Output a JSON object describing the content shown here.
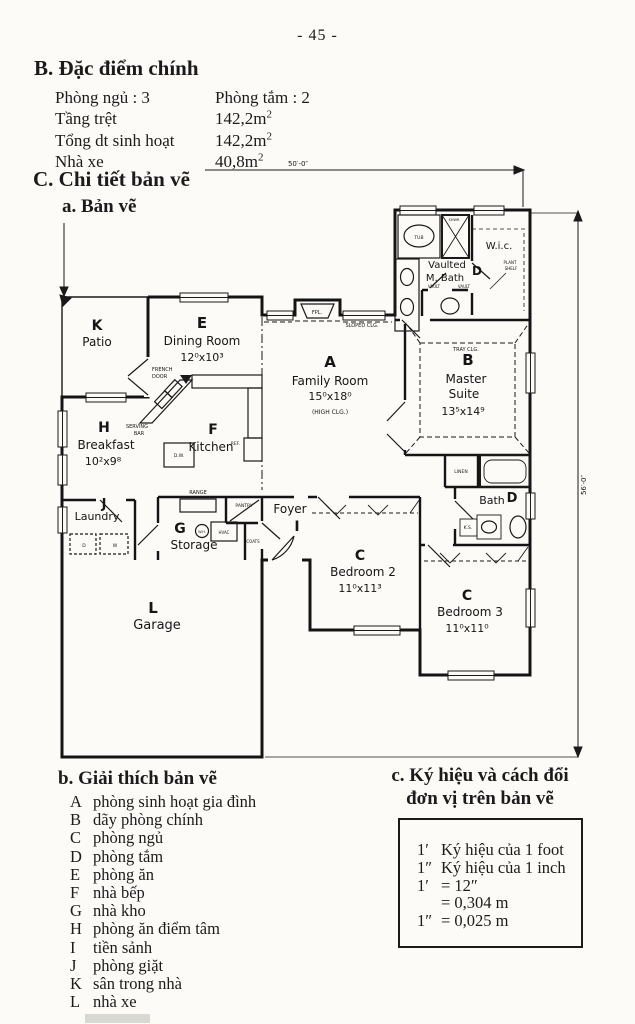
{
  "page": {
    "number": "- 45 -"
  },
  "specs": {
    "heading": "B. Đặc điểm chính",
    "rows": [
      {
        "label": "Phòng ngủ : 3",
        "value": "Phòng tắm : 2",
        "sup": ""
      },
      {
        "label": "Tầng trệt",
        "value": "142,2m",
        "sup": "2"
      },
      {
        "label": "Tổng dt sinh hoạt",
        "value": "142,2m",
        "sup": "2"
      },
      {
        "label": "Nhà xe",
        "value": "40,8m",
        "sup": "2"
      }
    ]
  },
  "details": {
    "heading": "C. Chi tiết bản vẽ",
    "sub_a": "a. Bản vẽ"
  },
  "legend": {
    "heading": "b. Giải thích bản vẽ",
    "items": [
      {
        "key": "A",
        "label": "phòng sinh hoạt gia đình"
      },
      {
        "key": "B",
        "label": "dãy phòng chính"
      },
      {
        "key": "C",
        "label": "phòng ngủ"
      },
      {
        "key": "D",
        "label": "phòng tắm"
      },
      {
        "key": "E",
        "label": "phòng ăn"
      },
      {
        "key": "F",
        "label": "nhà bếp"
      },
      {
        "key": "G",
        "label": "nhà kho"
      },
      {
        "key": "H",
        "label": "phòng ăn điểm tâm"
      },
      {
        "key": "I",
        "label": "tiền sảnh"
      },
      {
        "key": "J",
        "label": "phòng giặt"
      },
      {
        "key": "K",
        "label": "sân trong nhà"
      },
      {
        "key": "L",
        "label": "nhà xe"
      }
    ]
  },
  "conversion": {
    "heading_line1": "c. Ký hiệu và cách đổi",
    "heading_line2": "đơn vị trên bản vẽ",
    "rows": [
      {
        "sym": "1′",
        "val": "Ký hiệu của 1 foot"
      },
      {
        "sym": "1″",
        "val": "Ký hiệu của 1 inch"
      },
      {
        "sym": "1′",
        "val": "= 12″"
      },
      {
        "sym": "",
        "val": "= 0,304 m"
      },
      {
        "sym": "1″",
        "val": "= 0,025 m"
      }
    ]
  },
  "plan": {
    "labels": [
      {
        "t": "50′-0″",
        "x": 258,
        "y": 11,
        "s": 7
      },
      {
        "t": "56′-0″",
        "x": 546,
        "y": 330,
        "s": 7,
        "rot": -90
      },
      {
        "t": "K",
        "x": 57,
        "y": 175,
        "s": 14,
        "w": "bold"
      },
      {
        "t": "Patio",
        "x": 57,
        "y": 191,
        "s": 12
      },
      {
        "t": "E",
        "x": 162,
        "y": 173,
        "s": 15,
        "w": "bold"
      },
      {
        "t": "Dining Room",
        "x": 162,
        "y": 190,
        "s": 12
      },
      {
        "t": "12⁰x10³",
        "x": 162,
        "y": 206,
        "s": 11
      },
      {
        "t": "FRENCH",
        "x": 112,
        "y": 216,
        "s": 5,
        "a": "start"
      },
      {
        "t": "DOOR",
        "x": 112,
        "y": 223,
        "s": 5,
        "a": "start"
      },
      {
        "t": "FPL.",
        "x": 277,
        "y": 159,
        "s": 5
      },
      {
        "t": "SLOPED CLG.",
        "x": 322,
        "y": 172,
        "s": 5
      },
      {
        "t": "A",
        "x": 290,
        "y": 212,
        "s": 15,
        "w": "bold"
      },
      {
        "t": "Family Room",
        "x": 290,
        "y": 230,
        "s": 12
      },
      {
        "t": "15⁰x18⁰",
        "x": 290,
        "y": 245,
        "s": 11
      },
      {
        "t": "(HIGH CLG.)",
        "x": 290,
        "y": 259,
        "s": 6
      },
      {
        "t": "H",
        "x": 64,
        "y": 277,
        "s": 14,
        "w": "bold"
      },
      {
        "t": "Breakfast",
        "x": 66,
        "y": 294,
        "s": 12
      },
      {
        "t": "10²x9⁸",
        "x": 63,
        "y": 310,
        "s": 11
      },
      {
        "t": "SERVING",
        "x": 97,
        "y": 273,
        "s": 5
      },
      {
        "t": "BAR",
        "x": 99,
        "y": 280,
        "s": 5
      },
      {
        "t": "F",
        "x": 173,
        "y": 279,
        "s": 14,
        "w": "bold"
      },
      {
        "t": "Kitchen",
        "x": 171,
        "y": 296,
        "s": 12
      },
      {
        "t": "D.W.",
        "x": 139,
        "y": 302,
        "s": 4.5
      },
      {
        "t": "REF.",
        "x": 200,
        "y": 290,
        "s": 4.5,
        "a": "end"
      },
      {
        "t": "RANGE",
        "x": 158,
        "y": 339,
        "s": 5
      },
      {
        "t": "PANTRY",
        "x": 204,
        "y": 352,
        "s": 4.5
      },
      {
        "t": "J",
        "x": 64,
        "y": 353,
        "s": 13,
        "w": "bold"
      },
      {
        "t": "Laundry",
        "x": 57,
        "y": 365,
        "s": 11
      },
      {
        "t": "D",
        "x": 44,
        "y": 392,
        "s": 4.5
      },
      {
        "t": "W",
        "x": 75,
        "y": 392,
        "s": 4.5
      },
      {
        "t": "G",
        "x": 140,
        "y": 378,
        "s": 14,
        "w": "bold"
      },
      {
        "t": "Storage",
        "x": 154,
        "y": 394,
        "s": 12
      },
      {
        "t": "W.H.",
        "x": 162,
        "y": 378,
        "s": 3.5
      },
      {
        "t": "HVAC",
        "x": 184,
        "y": 379,
        "s": 4
      },
      {
        "t": "COATS",
        "x": 213,
        "y": 388,
        "s": 4
      },
      {
        "t": "Foyer",
        "x": 250,
        "y": 358,
        "s": 12
      },
      {
        "t": "I",
        "x": 257,
        "y": 376,
        "s": 14,
        "w": "bold"
      },
      {
        "t": "L",
        "x": 113,
        "y": 458,
        "s": 15,
        "w": "bold"
      },
      {
        "t": "Garage",
        "x": 117,
        "y": 474,
        "s": 13
      },
      {
        "t": "C",
        "x": 320,
        "y": 405,
        "s": 14,
        "w": "bold"
      },
      {
        "t": "Bedroom 2",
        "x": 323,
        "y": 421,
        "s": 12
      },
      {
        "t": "11⁰x11³",
        "x": 320,
        "y": 437,
        "s": 11
      },
      {
        "t": "C",
        "x": 427,
        "y": 445,
        "s": 14,
        "w": "bold"
      },
      {
        "t": "Bedroom 3",
        "x": 430,
        "y": 461,
        "s": 12
      },
      {
        "t": "11⁰x11⁰",
        "x": 427,
        "y": 477,
        "s": 11
      },
      {
        "t": "Bath",
        "x": 452,
        "y": 349,
        "s": 11
      },
      {
        "t": "D",
        "x": 472,
        "y": 347,
        "s": 13,
        "w": "bold"
      },
      {
        "t": "K.S.",
        "x": 428,
        "y": 374,
        "s": 4.5
      },
      {
        "t": "LINEN",
        "x": 421,
        "y": 318,
        "s": 4.5
      },
      {
        "t": "TRAY CLG.",
        "x": 426,
        "y": 196,
        "s": 5
      },
      {
        "t": "B",
        "x": 428,
        "y": 210,
        "s": 15,
        "w": "bold"
      },
      {
        "t": "Master",
        "x": 426,
        "y": 228,
        "s": 12
      },
      {
        "t": "Suite",
        "x": 424,
        "y": 243,
        "s": 12
      },
      {
        "t": "13⁵x14⁹",
        "x": 423,
        "y": 260,
        "s": 11
      },
      {
        "t": "TUB",
        "x": 379,
        "y": 84,
        "s": 4.5
      },
      {
        "t": "SHWR",
        "x": 414,
        "y": 66,
        "s": 3.5
      },
      {
        "t": "W.i.c.",
        "x": 459,
        "y": 94,
        "s": 10
      },
      {
        "t": "Vaulted",
        "x": 407,
        "y": 113,
        "s": 10
      },
      {
        "t": "M. Bath",
        "x": 405,
        "y": 126,
        "s": 10
      },
      {
        "t": "VAULT",
        "x": 394,
        "y": 133,
        "s": 4
      },
      {
        "t": "VAULT",
        "x": 424,
        "y": 133,
        "s": 4
      },
      {
        "t": "D",
        "x": 437,
        "y": 120,
        "s": 12,
        "w": "bold"
      },
      {
        "t": "PLANT",
        "x": 470,
        "y": 109,
        "s": 4
      },
      {
        "t": "SHELF",
        "x": 471,
        "y": 115,
        "s": 4
      }
    ]
  }
}
